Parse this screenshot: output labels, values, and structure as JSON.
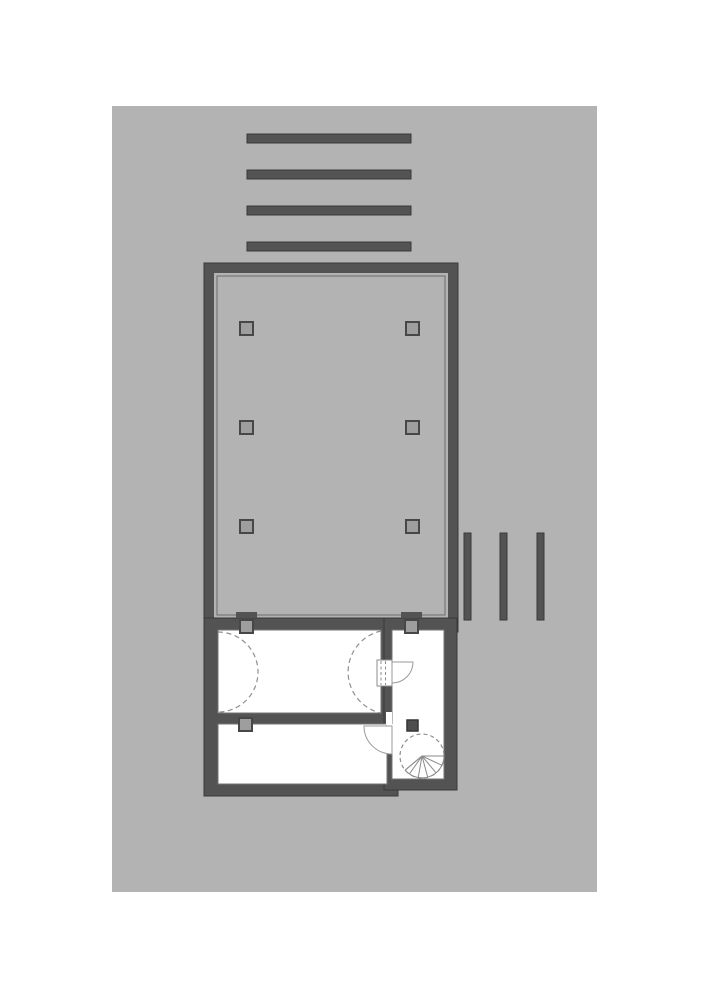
{
  "canvas": {
    "width": 707,
    "height": 1000,
    "background": "#ffffff"
  },
  "palette": {
    "sheet": "#b3b3b3",
    "wall_fill": "#535353",
    "wall_outline": "#3a3a3a",
    "floor": "#b3b3b3",
    "floor_inner_line": "#6b6b6b",
    "room_fill": "#ffffff",
    "room_stroke": "#757575",
    "column_fill": "#9e9e9e",
    "column_stroke": "#474747",
    "dash_stroke": "#8f8f8f",
    "door_stroke": "#9a9a9a",
    "solid_column_fill": "#4e4e4e"
  },
  "plan": {
    "shapes": [
      {
        "name": "drawing-sheet",
        "tag": "rect",
        "attrs": {
          "x": 112,
          "y": 106,
          "width": 485,
          "height": 786,
          "fill": "#b3b3b3"
        }
      },
      {
        "name": "pergola-bar-h-1",
        "tag": "rect",
        "attrs": {
          "x": 247,
          "y": 134,
          "width": 164,
          "height": 9,
          "fill": "#535353",
          "stroke": "#3a3a3a",
          "stroke-width": 1
        }
      },
      {
        "name": "pergola-bar-h-2",
        "tag": "rect",
        "attrs": {
          "x": 247,
          "y": 170,
          "width": 164,
          "height": 9,
          "fill": "#535353",
          "stroke": "#3a3a3a",
          "stroke-width": 1
        }
      },
      {
        "name": "pergola-bar-h-3",
        "tag": "rect",
        "attrs": {
          "x": 247,
          "y": 206,
          "width": 164,
          "height": 9,
          "fill": "#535353",
          "stroke": "#3a3a3a",
          "stroke-width": 1
        }
      },
      {
        "name": "pergola-bar-h-4",
        "tag": "rect",
        "attrs": {
          "x": 247,
          "y": 242,
          "width": 164,
          "height": 9,
          "fill": "#535353",
          "stroke": "#3a3a3a",
          "stroke-width": 1
        }
      },
      {
        "name": "deck-bar-v-1",
        "tag": "rect",
        "attrs": {
          "x": 464,
          "y": 533,
          "width": 7,
          "height": 87,
          "fill": "#535353",
          "stroke": "#3a3a3a",
          "stroke-width": 1
        }
      },
      {
        "name": "deck-bar-v-2",
        "tag": "rect",
        "attrs": {
          "x": 500,
          "y": 533,
          "width": 7,
          "height": 87,
          "fill": "#535353",
          "stroke": "#3a3a3a",
          "stroke-width": 1
        }
      },
      {
        "name": "deck-bar-v-3",
        "tag": "rect",
        "attrs": {
          "x": 537,
          "y": 533,
          "width": 7,
          "height": 87,
          "fill": "#535353",
          "stroke": "#3a3a3a",
          "stroke-width": 1
        }
      },
      {
        "name": "main-hall-walls",
        "tag": "rect",
        "attrs": {
          "x": 204,
          "y": 263,
          "width": 254,
          "height": 369,
          "fill": "#535353",
          "stroke": "#3a3a3a",
          "stroke-width": 1
        }
      },
      {
        "name": "main-hall-floor",
        "tag": "rect",
        "attrs": {
          "x": 214,
          "y": 273,
          "width": 234,
          "height": 345,
          "fill": "#b3b3b3"
        }
      },
      {
        "name": "main-hall-floor-inner-line",
        "tag": "rect",
        "attrs": {
          "x": 217,
          "y": 276,
          "width": 228,
          "height": 339,
          "fill": "none",
          "stroke": "#6b6b6b",
          "stroke-width": 1
        }
      },
      {
        "name": "hall-column-1",
        "tag": "rect",
        "attrs": {
          "x": 240,
          "y": 322,
          "width": 13,
          "height": 13,
          "fill": "#9e9e9e",
          "stroke": "#474747",
          "stroke-width": 2
        }
      },
      {
        "name": "hall-column-2",
        "tag": "rect",
        "attrs": {
          "x": 406,
          "y": 322,
          "width": 13,
          "height": 13,
          "fill": "#9e9e9e",
          "stroke": "#474747",
          "stroke-width": 2
        }
      },
      {
        "name": "hall-column-3",
        "tag": "rect",
        "attrs": {
          "x": 240,
          "y": 421,
          "width": 13,
          "height": 13,
          "fill": "#9e9e9e",
          "stroke": "#474747",
          "stroke-width": 2
        }
      },
      {
        "name": "hall-column-4",
        "tag": "rect",
        "attrs": {
          "x": 406,
          "y": 421,
          "width": 13,
          "height": 13,
          "fill": "#9e9e9e",
          "stroke": "#474747",
          "stroke-width": 2
        }
      },
      {
        "name": "hall-column-5",
        "tag": "rect",
        "attrs": {
          "x": 240,
          "y": 520,
          "width": 13,
          "height": 13,
          "fill": "#9e9e9e",
          "stroke": "#474747",
          "stroke-width": 2
        }
      },
      {
        "name": "hall-column-6",
        "tag": "rect",
        "attrs": {
          "x": 406,
          "y": 520,
          "width": 13,
          "height": 13,
          "fill": "#9e9e9e",
          "stroke": "#474747",
          "stroke-width": 2
        }
      },
      {
        "name": "lower-left-wall-block",
        "tag": "rect",
        "attrs": {
          "x": 204,
          "y": 618,
          "width": 194,
          "height": 178,
          "fill": "#535353",
          "stroke": "#3a3a3a",
          "stroke-width": 1
        }
      },
      {
        "name": "lower-right-wall-block",
        "tag": "rect",
        "attrs": {
          "x": 384,
          "y": 618,
          "width": 73,
          "height": 172,
          "fill": "#535353",
          "stroke": "#3a3a3a",
          "stroke-width": 1
        }
      },
      {
        "name": "room-upper-left",
        "tag": "rect",
        "attrs": {
          "x": 218,
          "y": 630,
          "width": 163,
          "height": 83,
          "fill": "#ffffff",
          "stroke": "#757575",
          "stroke-width": 1
        }
      },
      {
        "name": "room-lower-left",
        "tag": "rect",
        "attrs": {
          "x": 218,
          "y": 724,
          "width": 169,
          "height": 60,
          "fill": "#ffffff",
          "stroke": "#757575",
          "stroke-width": 1
        }
      },
      {
        "name": "room-stair-right",
        "tag": "rect",
        "attrs": {
          "x": 392,
          "y": 630,
          "width": 52,
          "height": 149,
          "fill": "#ffffff",
          "stroke": "#757575",
          "stroke-width": 1
        }
      },
      {
        "name": "wall-opening-middle",
        "tag": "rect",
        "attrs": {
          "x": 386,
          "y": 712,
          "width": 6,
          "height": 13,
          "fill": "#ffffff"
        }
      },
      {
        "name": "wall-opening-right-gap",
        "tag": "rect",
        "attrs": {
          "x": 387,
          "y": 724,
          "width": 6,
          "height": 30,
          "fill": "#ffffff"
        }
      },
      {
        "name": "door-1-pocket",
        "tag": "rect",
        "attrs": {
          "x": 377,
          "y": 660,
          "width": 15,
          "height": 26,
          "fill": "#ffffff",
          "stroke": "#8e8e8e",
          "stroke-width": 1
        }
      },
      {
        "name": "door-1-leaf-dashed-a",
        "tag": "line",
        "attrs": {
          "x1": 381,
          "y1": 661,
          "x2": 381,
          "y2": 685,
          "stroke": "#8e8e8e",
          "stroke-width": 1,
          "stroke-dasharray": "3 2.5"
        }
      },
      {
        "name": "door-1-leaf-dashed-b",
        "tag": "line",
        "attrs": {
          "x1": 385.5,
          "y1": 661,
          "x2": 385.5,
          "y2": 685,
          "stroke": "#8e8e8e",
          "stroke-width": 1,
          "stroke-dasharray": "3 2.5"
        }
      },
      {
        "name": "door-1-swing",
        "tag": "path",
        "attrs": {
          "d": "M392,662 L413,662 A21,21 0 0 1 392,683 Z",
          "fill": "#ffffff",
          "stroke": "#9a9a9a",
          "stroke-width": 1
        }
      },
      {
        "name": "door-2-swing",
        "tag": "path",
        "attrs": {
          "d": "M392,726 L364,726 A28,28 0 0 0 392,754 Z",
          "fill": "#ffffff",
          "stroke": "#9a9a9a",
          "stroke-width": 1
        }
      },
      {
        "name": "swing-arc-left",
        "tag": "path",
        "attrs": {
          "d": "M218,632 A40,40 0 0 1 218,712",
          "fill": "none",
          "stroke": "#8f8f8f",
          "stroke-width": 1.2,
          "stroke-dasharray": "5 3.5"
        }
      },
      {
        "name": "swing-arc-right",
        "tag": "path",
        "attrs": {
          "d": "M381,631 A42,42 0 0 0 381,713",
          "fill": "none",
          "stroke": "#8f8f8f",
          "stroke-width": 1.2,
          "stroke-dasharray": "5 3.5"
        }
      },
      {
        "name": "wall-column-tab-1",
        "tag": "rect",
        "attrs": {
          "x": 236,
          "y": 612,
          "width": 21,
          "height": 6,
          "fill": "#535353"
        }
      },
      {
        "name": "wall-column-tab-2",
        "tag": "rect",
        "attrs": {
          "x": 401,
          "y": 612,
          "width": 21,
          "height": 6,
          "fill": "#535353"
        }
      },
      {
        "name": "wall-column-1",
        "tag": "rect",
        "attrs": {
          "x": 240,
          "y": 620,
          "width": 13,
          "height": 13,
          "fill": "#9e9e9e",
          "stroke": "#474747",
          "stroke-width": 2
        }
      },
      {
        "name": "wall-column-2",
        "tag": "rect",
        "attrs": {
          "x": 405,
          "y": 620,
          "width": 13,
          "height": 13,
          "fill": "#9e9e9e",
          "stroke": "#474747",
          "stroke-width": 2
        }
      },
      {
        "name": "wall-column-3",
        "tag": "rect",
        "attrs": {
          "x": 239,
          "y": 718,
          "width": 13,
          "height": 13,
          "fill": "#9e9e9e",
          "stroke": "#474747",
          "stroke-width": 2
        }
      },
      {
        "name": "stair-room-column",
        "tag": "rect",
        "attrs": {
          "x": 407,
          "y": 720,
          "width": 11,
          "height": 11,
          "fill": "#4e4e4e",
          "stroke": "#353535",
          "stroke-width": 1.5
        }
      },
      {
        "name": "spiral-stair-circle",
        "tag": "circle",
        "attrs": {
          "cx": 422,
          "cy": 756,
          "r": 22,
          "fill": "none",
          "stroke": "#8f8f8f",
          "stroke-width": 1.2,
          "stroke-dasharray": "4 3"
        }
      },
      {
        "name": "spiral-stair-fan",
        "tag": "path",
        "attrs": {
          "d": "M422,756 L444,756 A22,22 0 0 1 405.2,770.1 Z",
          "fill": "#ffffff",
          "stroke": "#8a8a8a",
          "stroke-width": 1
        }
      },
      {
        "name": "spiral-stair-tread-1",
        "tag": "line",
        "attrs": {
          "x1": 422,
          "y1": 756,
          "x2": 444,
          "y2": 756,
          "stroke": "#8a8a8a",
          "stroke-width": 1
        }
      },
      {
        "name": "spiral-stair-tread-2",
        "tag": "line",
        "attrs": {
          "x1": 422,
          "y1": 756,
          "x2": 441.9,
          "y2": 765.3,
          "stroke": "#8a8a8a",
          "stroke-width": 1
        }
      },
      {
        "name": "spiral-stair-tread-3",
        "tag": "line",
        "attrs": {
          "x1": 422,
          "y1": 756,
          "x2": 436.1,
          "y2": 772.9,
          "stroke": "#8a8a8a",
          "stroke-width": 1
        }
      },
      {
        "name": "spiral-stair-tread-4",
        "tag": "line",
        "attrs": {
          "x1": 422,
          "y1": 756,
          "x2": 427.7,
          "y2": 777.3,
          "stroke": "#8a8a8a",
          "stroke-width": 1
        }
      },
      {
        "name": "spiral-stair-tread-5",
        "tag": "line",
        "attrs": {
          "x1": 422,
          "y1": 756,
          "x2": 418.2,
          "y2": 777.7,
          "stroke": "#8a8a8a",
          "stroke-width": 1
        }
      },
      {
        "name": "spiral-stair-tread-6",
        "tag": "line",
        "attrs": {
          "x1": 422,
          "y1": 756,
          "x2": 409.4,
          "y2": 774,
          "stroke": "#8a8a8a",
          "stroke-width": 1
        }
      },
      {
        "name": "spiral-stair-tread-7",
        "tag": "line",
        "attrs": {
          "x1": 422,
          "y1": 756,
          "x2": 405.2,
          "y2": 770.1,
          "stroke": "#8a8a8a",
          "stroke-width": 1
        }
      }
    ]
  }
}
